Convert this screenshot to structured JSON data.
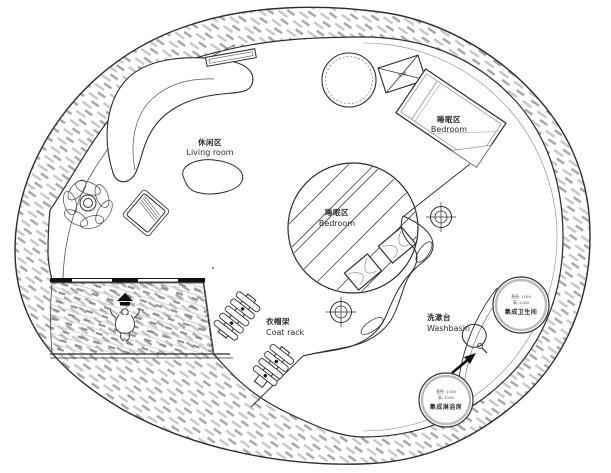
{
  "canvas": {
    "width": 611,
    "height": 473,
    "background": "#ffffff",
    "line_color": "#2b2b2b",
    "wall_hatch_light": "#c6c6c6",
    "wall_hatch_dark": "#a4a4a4",
    "deck_hatch": "#8f8f8f"
  },
  "zones": {
    "living_room": {
      "cn": "休闲区",
      "en": "Living room"
    },
    "bedroom_upper": {
      "cn": "睡眠区",
      "en": "Bedroom"
    },
    "bedroom_loft": {
      "cn": "睡眠区",
      "en": "Bedroom"
    },
    "coat_rack": {
      "cn": "衣帽架",
      "en": "Coat rack"
    },
    "washbasin": {
      "cn": "洗漱台",
      "en": "Washbasin"
    }
  },
  "pods": {
    "bathroom": {
      "dim_diameter": "直径: 1100",
      "dim_height": "高: 2100",
      "name": "集成卫生间"
    },
    "shower": {
      "dim_diameter": "直径: 1100",
      "dim_height": "高: 2100",
      "name": "集成淋浴房"
    }
  },
  "equipment": {
    "ac_unit": "空调"
  }
}
